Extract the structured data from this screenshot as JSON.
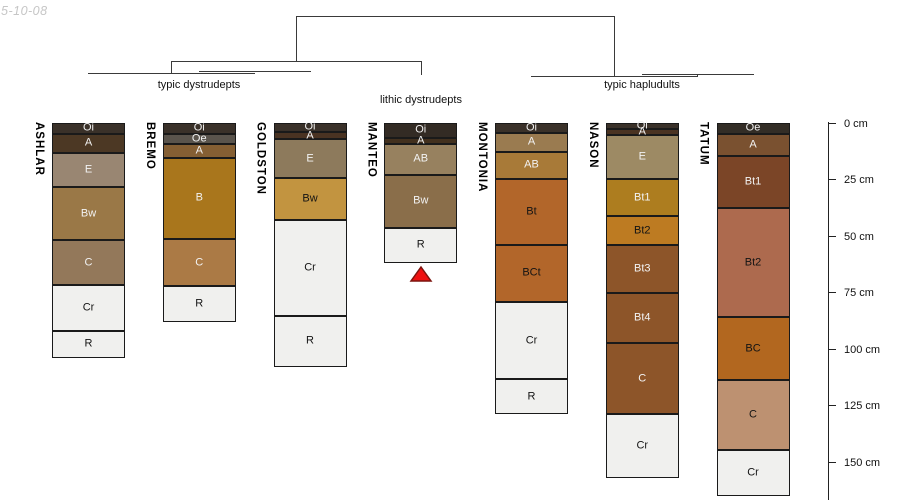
{
  "watermark": "5-10-08",
  "dendrogram": {
    "groups": [
      {
        "label": "typic dystrudepts",
        "members": [
          "ASHLAR",
          "BREMO",
          "GOLDSTON"
        ]
      },
      {
        "label": "lithic dystrudepts",
        "members": [
          "MANTEO"
        ]
      },
      {
        "label": "typic hapludults",
        "members": [
          "MONTONIA",
          "NASON",
          "TATUM"
        ]
      }
    ]
  },
  "marker": {
    "shape": "red-triangle",
    "under_profile": "MANTEO",
    "fill": "#ee1111",
    "outline": "#7c140e"
  },
  "chart_data": {
    "type": "soil-profile-columns",
    "depth_axis": {
      "unit": "cm",
      "ticks": [
        0,
        25,
        50,
        75,
        100,
        125,
        150
      ],
      "labels": [
        "0 cm",
        "25 cm",
        "50 cm",
        "75 cm",
        "100 cm",
        "125 cm",
        "150 cm"
      ]
    },
    "profiles": [
      {
        "name": "ASHLAR",
        "group": "typic dystrudepts",
        "horizons": [
          {
            "label": "Oi",
            "top_cm": 0,
            "bottom_cm": 5,
            "color": "#3a3129",
            "text": "#f2f2f2"
          },
          {
            "label": "A",
            "top_cm": 5,
            "bottom_cm": 13.5,
            "color": "#4c3824",
            "text": "#f2f2f2"
          },
          {
            "label": "E",
            "top_cm": 13.5,
            "bottom_cm": 28.5,
            "color": "#998672",
            "text": "#f2f2f2"
          },
          {
            "label": "Bw",
            "top_cm": 28.5,
            "bottom_cm": 52,
            "color": "#9a7847",
            "text": "#f2f2f2"
          },
          {
            "label": "C",
            "top_cm": 52,
            "bottom_cm": 72,
            "color": "#93785a",
            "text": "#f2f2f2"
          },
          {
            "label": "Cr",
            "top_cm": 72,
            "bottom_cm": 92,
            "color": "#f0f0ee",
            "text": "#141414"
          },
          {
            "label": "R",
            "top_cm": 92,
            "bottom_cm": 104,
            "color": "#f0f0ee",
            "text": "#141414"
          }
        ]
      },
      {
        "name": "BREMO",
        "group": "typic dystrudepts",
        "horizons": [
          {
            "label": "Oi",
            "top_cm": 0,
            "bottom_cm": 5,
            "color": "#3a3129",
            "text": "#f2f2f2"
          },
          {
            "label": "Oe",
            "top_cm": 5,
            "bottom_cm": 9.5,
            "color": "#5a544c",
            "text": "#f2f2f2"
          },
          {
            "label": "A",
            "top_cm": 9.5,
            "bottom_cm": 15.5,
            "color": "#855f33",
            "text": "#f2f2f2"
          },
          {
            "label": "B",
            "top_cm": 15.5,
            "bottom_cm": 51.5,
            "color": "#a9761c",
            "text": "#f2f2f2"
          },
          {
            "label": "C",
            "top_cm": 51.5,
            "bottom_cm": 72.5,
            "color": "#ab7a45",
            "text": "#f2f2f2"
          },
          {
            "label": "R",
            "top_cm": 72.5,
            "bottom_cm": 88,
            "color": "#f0f0ee",
            "text": "#141414"
          }
        ]
      },
      {
        "name": "GOLDSTON",
        "group": "typic dystrudepts",
        "horizons": [
          {
            "label": "Oi",
            "top_cm": 0,
            "bottom_cm": 4,
            "color": "#3a3129",
            "text": "#f2f2f2"
          },
          {
            "label": "A",
            "top_cm": 4,
            "bottom_cm": 7.5,
            "color": "#4a3322",
            "text": "#f2f2f2"
          },
          {
            "label": "E",
            "top_cm": 7.5,
            "bottom_cm": 24.5,
            "color": "#8d7a5c",
            "text": "#f2f2f2"
          },
          {
            "label": "Bw",
            "top_cm": 24.5,
            "bottom_cm": 43,
            "color": "#c29440",
            "text": "#141414"
          },
          {
            "label": "Cr",
            "top_cm": 43,
            "bottom_cm": 85.5,
            "color": "#f0f0ee",
            "text": "#141414"
          },
          {
            "label": "R",
            "top_cm": 85.5,
            "bottom_cm": 108,
            "color": "#f0f0ee",
            "text": "#141414"
          }
        ]
      },
      {
        "name": "MANTEO",
        "group": "lithic dystrudepts",
        "horizons": [
          {
            "label": "Oi",
            "top_cm": 0,
            "bottom_cm": 7,
            "color": "#332b24",
            "text": "#f2f2f2"
          },
          {
            "label": "A",
            "top_cm": 7,
            "bottom_cm": 9.5,
            "color": "#42301e",
            "text": "#f2f2f2"
          },
          {
            "label": "AB",
            "top_cm": 9.5,
            "bottom_cm": 23,
            "color": "#97815f",
            "text": "#f2f2f2"
          },
          {
            "label": "Bw",
            "top_cm": 23,
            "bottom_cm": 46.5,
            "color": "#8a6e4a",
            "text": "#f2f2f2"
          },
          {
            "label": "R",
            "top_cm": 46.5,
            "bottom_cm": 62,
            "color": "#f0f0ee",
            "text": "#141414"
          }
        ]
      },
      {
        "name": "MONTONIA",
        "group": "typic hapludults",
        "horizons": [
          {
            "label": "Oi",
            "top_cm": 0,
            "bottom_cm": 4.5,
            "color": "#3a3129",
            "text": "#f2f2f2"
          },
          {
            "label": "A",
            "top_cm": 4.5,
            "bottom_cm": 13,
            "color": "#9a7b50",
            "text": "#f2f2f2"
          },
          {
            "label": "AB",
            "top_cm": 13,
            "bottom_cm": 25,
            "color": "#a87a38",
            "text": "#f2f2f2"
          },
          {
            "label": "Bt",
            "top_cm": 25,
            "bottom_cm": 54,
            "color": "#b2662a",
            "text": "#141414"
          },
          {
            "label": "BCt",
            "top_cm": 54,
            "bottom_cm": 79.5,
            "color": "#b2662a",
            "text": "#141414"
          },
          {
            "label": "Cr",
            "top_cm": 79.5,
            "bottom_cm": 113.5,
            "color": "#f0f0ee",
            "text": "#141414"
          },
          {
            "label": "R",
            "top_cm": 113.5,
            "bottom_cm": 129,
            "color": "#f0f0ee",
            "text": "#141414"
          }
        ]
      },
      {
        "name": "NASON",
        "group": "typic hapludults",
        "horizons": [
          {
            "label": "Oi",
            "top_cm": 0,
            "bottom_cm": 3,
            "color": "#3a3129",
            "text": "#f2f2f2"
          },
          {
            "label": "A",
            "top_cm": 3,
            "bottom_cm": 5.5,
            "color": "#4a3322",
            "text": "#f2f2f2"
          },
          {
            "label": "E",
            "top_cm": 5.5,
            "bottom_cm": 25,
            "color": "#9d8a64",
            "text": "#f2f2f2"
          },
          {
            "label": "Bt1",
            "top_cm": 25,
            "bottom_cm": 41.5,
            "color": "#ad7d1f",
            "text": "#f2f2f2"
          },
          {
            "label": "Bt2",
            "top_cm": 41.5,
            "bottom_cm": 54,
            "color": "#bd7b22",
            "text": "#141414"
          },
          {
            "label": "Bt3",
            "top_cm": 54,
            "bottom_cm": 75.5,
            "color": "#8d5529",
            "text": "#f2f2f2"
          },
          {
            "label": "Bt4",
            "top_cm": 75.5,
            "bottom_cm": 97.5,
            "color": "#8d5529",
            "text": "#f2f2f2"
          },
          {
            "label": "C",
            "top_cm": 97.5,
            "bottom_cm": 129,
            "color": "#8d5529",
            "text": "#f2f2f2"
          },
          {
            "label": "Cr",
            "top_cm": 129,
            "bottom_cm": 157,
            "color": "#f0f0ee",
            "text": "#141414"
          }
        ]
      },
      {
        "name": "TATUM",
        "group": "typic hapludults",
        "horizons": [
          {
            "label": "Oe",
            "top_cm": 0,
            "bottom_cm": 5,
            "color": "#332d26",
            "text": "#f2f2f2"
          },
          {
            "label": "A",
            "top_cm": 5,
            "bottom_cm": 15,
            "color": "#7a5130",
            "text": "#f2f2f2"
          },
          {
            "label": "Bt1",
            "top_cm": 15,
            "bottom_cm": 38,
            "color": "#7b4527",
            "text": "#f2f2f2"
          },
          {
            "label": "Bt2",
            "top_cm": 38,
            "bottom_cm": 86,
            "color": "#ad6a4e",
            "text": "#141414"
          },
          {
            "label": "BC",
            "top_cm": 86,
            "bottom_cm": 114,
            "color": "#b2671f",
            "text": "#141414"
          },
          {
            "label": "C",
            "top_cm": 114,
            "bottom_cm": 145,
            "color": "#bd9171",
            "text": "#141414"
          },
          {
            "label": "Cr",
            "top_cm": 145,
            "bottom_cm": 165,
            "color": "#f0f0ee",
            "text": "#141414"
          }
        ]
      }
    ]
  }
}
